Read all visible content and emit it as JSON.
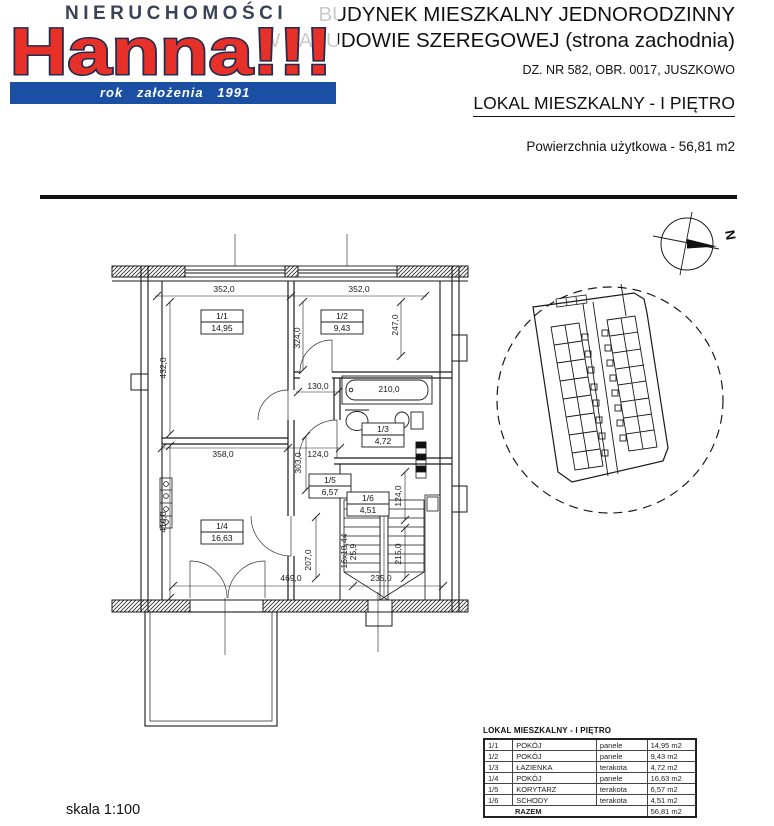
{
  "logo": {
    "nieruchomosci": "NIERUCHOMOŚCI",
    "name": "Hanna!!!",
    "established": "rok założenia 1991",
    "brand_red": "#e63028",
    "brand_blue": "#1b4fa3"
  },
  "title": {
    "line1": "BUDYNEK MIESZKALNY JEDNORODZINNY",
    "line2": "W ZABUDOWIE SZEREGOWEJ (strona zachodnia)",
    "parcel": "DZ. NR 582, OBR. 0017, JUSZKOWO",
    "unit": "LOKAL MIESZKALNY - I PIĘTRO",
    "area_line": "Powierzchnia użytkowa -  56,81 m2"
  },
  "compass": {
    "north": "N"
  },
  "plan": {
    "rooms": [
      {
        "id": "1/1",
        "area": "14,95"
      },
      {
        "id": "1/2",
        "area": "9,43"
      },
      {
        "id": "1/3",
        "area": "4,72"
      },
      {
        "id": "1/4",
        "area": "16,63"
      },
      {
        "id": "1/5",
        "area": "6,57"
      },
      {
        "id": "1/6",
        "area": "4,51"
      }
    ],
    "dims": {
      "window_left": "352,0",
      "window_right": "352,0",
      "room1_depth": "432,0",
      "room2_depth": "324,0",
      "room2_right": "247,0",
      "hall_door": "130,0",
      "tub": "210,0",
      "wall_mid": "358,0",
      "hall_width": "124,0",
      "hall_height": "303,0",
      "room4_depth": "410,0",
      "hall_lower": "207,0",
      "bottom_left": "469,0",
      "bottom_right": "235,0",
      "stairs_steps": "16x18,44",
      "stairs_tread": "25,9",
      "stairs_run": "215,0",
      "stairs_right": "124,0"
    }
  },
  "table": {
    "title": "LOKAL MIESZKALNY - I PIĘTRO",
    "rows": [
      {
        "no": "1/1",
        "name": "POKÓJ",
        "finish": "panele",
        "area": "14,95 m2"
      },
      {
        "no": "1/2",
        "name": "POKÓJ",
        "finish": "panele",
        "area": "9,43 m2"
      },
      {
        "no": "1/3",
        "name": "ŁAZIENKA",
        "finish": "terakota",
        "area": "4,72 m2"
      },
      {
        "no": "1/4",
        "name": "POKÓJ",
        "finish": "panele",
        "area": "16,63 m2"
      },
      {
        "no": "1/5",
        "name": "KORYTARZ",
        "finish": "terakota",
        "area": "6,57 m2"
      },
      {
        "no": "1/6",
        "name": "SCHODY",
        "finish": "terakota",
        "area": "4,51 m2"
      }
    ],
    "total_label": "RAZEM",
    "total_area": "56,81 m2"
  },
  "footer": {
    "scale": "skala 1:100"
  }
}
